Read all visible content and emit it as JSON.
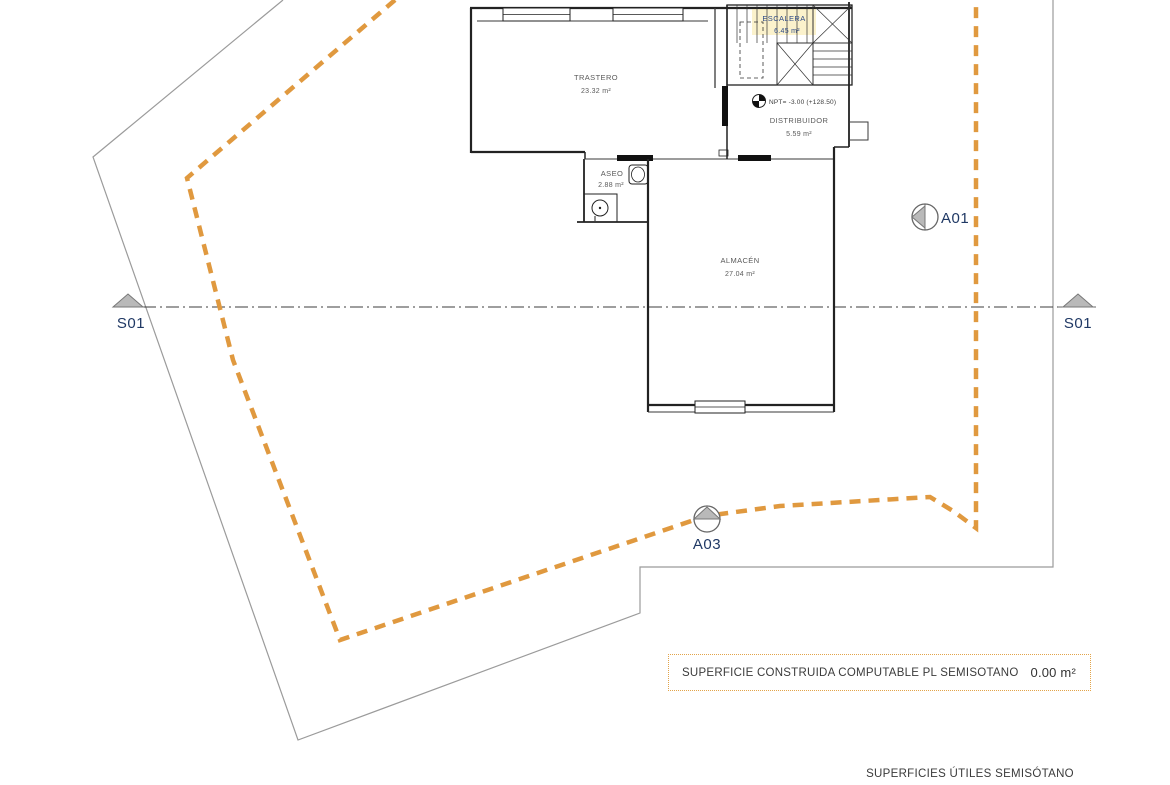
{
  "document": {
    "type": "floor-plan",
    "level": "semisótano"
  },
  "rooms": [
    {
      "name": "TRASTERO",
      "area": "23.32 m²"
    },
    {
      "name": "ESCALERA",
      "area": "6.45 m²"
    },
    {
      "name": "ASEO",
      "area": "2.88 m²"
    },
    {
      "name": "ALMACÉN",
      "area": "27.04 m²"
    },
    {
      "name": "DISTRIBUIDOR",
      "area": "5.59 m²"
    }
  ],
  "annotations": {
    "level_mark": "NPT= -3.00 (+128.50)"
  },
  "markers": {
    "section_left": "S01",
    "section_right": "S01",
    "elevation_a01": "A01",
    "elevation_a03": "A03"
  },
  "summary_box": {
    "label": "SUPERFICIE CONSTRUIDA COMPUTABLE PL SEMISOTANO",
    "value": "0.00 m²"
  },
  "footer": {
    "title": "SUPERFICIES ÚTILES SEMISÓTANO"
  },
  "colors": {
    "boundary_dashed": "#E0993F",
    "plot_line": "#9B9B9B",
    "plan_line": "#222222",
    "marker_fill": "#B9B9B9",
    "label_navy": "#1F3864",
    "label_gray": "#5A5A5A"
  }
}
